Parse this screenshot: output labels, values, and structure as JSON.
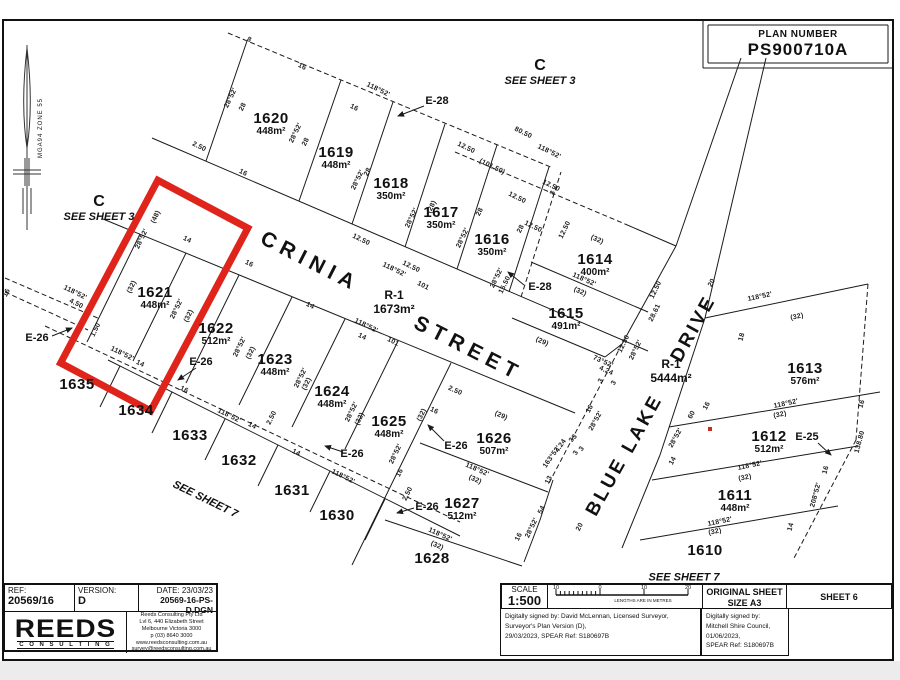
{
  "page": {
    "red": "#df241b",
    "line": "#1a1a1a"
  },
  "plan_number": {
    "label": "PLAN NUMBER",
    "value": "PS900710A"
  },
  "north": {
    "label": "MGA94  ZONE 55"
  },
  "sheet_refs": [
    {
      "big": "C",
      "sub": "SEE SHEET 3",
      "x": 540,
      "y": 72,
      "rot": 0
    },
    {
      "big": "C",
      "sub": "SEE SHEET 3",
      "x": 99,
      "y": 208,
      "rot": 0
    },
    {
      "big": "",
      "sub": "SEE SHEET 7",
      "x": 205,
      "y": 500,
      "rot": 26
    },
    {
      "big": "",
      "sub": "SEE SHEET 7",
      "x": 684,
      "y": 578,
      "rot": 0
    }
  ],
  "streets": {
    "names": [
      "CRINIA STREET",
      "BLUE LAKE DRIVE"
    ],
    "words": [
      {
        "text": "CRINIA",
        "x": 310,
        "y": 262,
        "rot": 27,
        "fs": 21,
        "ls": 6
      },
      {
        "text": "STREET",
        "x": 468,
        "y": 349,
        "rot": 27,
        "fs": 21,
        "ls": 6
      },
      {
        "text": "BLUE",
        "x": 607,
        "y": 487,
        "rot": -61,
        "fs": 19,
        "ls": 3
      },
      {
        "text": "LAKE",
        "x": 643,
        "y": 424,
        "rot": -61,
        "fs": 19,
        "ls": 3
      },
      {
        "text": "DRIVE",
        "x": 694,
        "y": 329,
        "rot": -61,
        "fs": 19,
        "ls": 3
      }
    ]
  },
  "reserves": [
    {
      "id": "R-1",
      "area": "1673m²",
      "x": 394,
      "y": 303
    },
    {
      "id": "R-1",
      "area": "5444m²",
      "x": 671,
      "y": 372
    }
  ],
  "lots": [
    {
      "num": "1620",
      "area": "448m²",
      "x": 271,
      "y": 124
    },
    {
      "num": "1619",
      "area": "448m²",
      "x": 336,
      "y": 158
    },
    {
      "num": "1618",
      "area": "350m²",
      "x": 391,
      "y": 189
    },
    {
      "num": "1617",
      "area": "350m²",
      "x": 441,
      "y": 218
    },
    {
      "num": "1616",
      "area": "350m²",
      "x": 492,
      "y": 245
    },
    {
      "num": "1614",
      "area": "400m²",
      "x": 595,
      "y": 265
    },
    {
      "num": "1615",
      "area": "491m²",
      "x": 566,
      "y": 319
    },
    {
      "num": "1613",
      "area": "576m²",
      "x": 805,
      "y": 374
    },
    {
      "num": "1612",
      "area": "512m²",
      "x": 769,
      "y": 442
    },
    {
      "num": "1611",
      "area": "448m²",
      "x": 735,
      "y": 501
    },
    {
      "num": "1610",
      "area": "",
      "x": 705,
      "y": 551
    },
    {
      "num": "1621",
      "area": "448m²",
      "x": 155,
      "y": 298,
      "highlight": true
    },
    {
      "num": "1622",
      "area": "512m²",
      "x": 216,
      "y": 334
    },
    {
      "num": "1623",
      "area": "448m²",
      "x": 275,
      "y": 365
    },
    {
      "num": "1624",
      "area": "448m²",
      "x": 332,
      "y": 397
    },
    {
      "num": "1625",
      "area": "448m²",
      "x": 389,
      "y": 427
    },
    {
      "num": "1626",
      "area": "507m²",
      "x": 494,
      "y": 444
    },
    {
      "num": "1627",
      "area": "512m²",
      "x": 462,
      "y": 509
    },
    {
      "num": "1628",
      "area": "",
      "x": 432,
      "y": 559
    },
    {
      "num": "1630",
      "area": "",
      "x": 337,
      "y": 516
    },
    {
      "num": "1631",
      "area": "",
      "x": 292,
      "y": 491
    },
    {
      "num": "1632",
      "area": "",
      "x": 239,
      "y": 461
    },
    {
      "num": "1633",
      "area": "",
      "x": 190,
      "y": 436
    },
    {
      "num": "1634",
      "area": "",
      "x": 136,
      "y": 411
    },
    {
      "num": "1635",
      "area": "",
      "x": 77,
      "y": 385
    }
  ],
  "easements": [
    {
      "id": "E-28",
      "x": 437,
      "y": 101,
      "arrow": [
        424,
        106,
        398,
        116
      ]
    },
    {
      "id": "E-28",
      "x": 540,
      "y": 287,
      "arrow": [
        524,
        285,
        508,
        272
      ]
    },
    {
      "id": "E-26",
      "x": 37,
      "y": 338,
      "arrow": [
        52,
        336,
        72,
        328
      ]
    },
    {
      "id": "E-26",
      "x": 201,
      "y": 362,
      "arrow": [
        196,
        368,
        178,
        380
      ]
    },
    {
      "id": "E-26",
      "x": 352,
      "y": 454,
      "arrow": [
        343,
        452,
        325,
        446
      ]
    },
    {
      "id": "E-26",
      "x": 456,
      "y": 446,
      "arrow": [
        444,
        441,
        428,
        425
      ]
    },
    {
      "id": "E-26",
      "x": 427,
      "y": 507,
      "arrow": [
        414,
        508,
        397,
        513
      ]
    },
    {
      "id": "E-25",
      "x": 807,
      "y": 437,
      "arrow": [
        818,
        443,
        831,
        455
      ]
    }
  ],
  "annotations": [
    [
      "8",
      249,
      40,
      26
    ],
    [
      "16",
      302,
      67,
      26
    ],
    [
      "118°52'",
      378,
      90,
      26
    ],
    [
      "16",
      354,
      108,
      26
    ],
    [
      "12.50",
      466,
      148,
      26
    ],
    [
      "80.50",
      523,
      133,
      26
    ],
    [
      "118°52'",
      549,
      152,
      26
    ],
    [
      "(101.50)",
      492,
      167,
      26
    ],
    [
      "12.50",
      551,
      186,
      26
    ],
    [
      "12.50",
      517,
      198,
      26
    ],
    [
      "12.50",
      533,
      227,
      26
    ],
    [
      "28°52'",
      231,
      98,
      -64
    ],
    [
      "28",
      243,
      107,
      -64
    ],
    [
      "2.50",
      199,
      147,
      26
    ],
    [
      "16",
      243,
      173,
      26
    ],
    [
      "28°52'",
      296,
      133,
      -64
    ],
    [
      "28",
      306,
      142,
      -64
    ],
    [
      "28°52'",
      358,
      180,
      -64
    ],
    [
      "28",
      368,
      172,
      -64
    ],
    [
      "28°52'",
      412,
      218,
      -64
    ],
    [
      "(28)",
      432,
      207,
      -64
    ],
    [
      "28°52'",
      463,
      238,
      -64
    ],
    [
      "28",
      480,
      212,
      -64
    ],
    [
      "28°52'",
      497,
      278,
      -64
    ],
    [
      "15.50",
      505,
      285,
      -64
    ],
    [
      "28",
      521,
      229,
      -64
    ],
    [
      "3",
      553,
      193,
      -64
    ],
    [
      "12.50",
      565,
      230,
      -64
    ],
    [
      "(32)",
      597,
      240,
      24
    ],
    [
      "118°52'",
      584,
      280,
      24
    ],
    [
      "(32)",
      580,
      292,
      24
    ],
    [
      "12.50",
      656,
      290,
      -64
    ],
    [
      "28.61",
      655,
      313,
      -64
    ],
    [
      "12.50",
      624,
      344,
      -64
    ],
    [
      "28°52'",
      636,
      350,
      -64
    ],
    [
      "73°52'",
      603,
      362,
      24
    ],
    [
      "4.24",
      606,
      371,
      24
    ],
    [
      "(29)",
      542,
      342,
      24
    ],
    [
      "12.50",
      361,
      240,
      26
    ],
    [
      "118°52'",
      394,
      270,
      26
    ],
    [
      "101",
      423,
      286,
      26
    ],
    [
      "12.50",
      411,
      267,
      26
    ],
    [
      "118°52'",
      366,
      326,
      26
    ],
    [
      "14",
      362,
      337,
      26
    ],
    [
      "101",
      393,
      342,
      26
    ],
    [
      "16",
      249,
      264,
      26
    ],
    [
      "14",
      310,
      306,
      26
    ],
    [
      "(48)",
      156,
      217,
      -64
    ],
    [
      "28°52'",
      142,
      239,
      -64
    ],
    [
      "14",
      187,
      240,
      26
    ],
    [
      "(32)",
      132,
      287,
      -64
    ],
    [
      "28°52'",
      177,
      309,
      -64
    ],
    [
      "(32)",
      189,
      316,
      -64
    ],
    [
      "118°52'",
      75,
      293,
      26
    ],
    [
      "4.50",
      76,
      304,
      26
    ],
    [
      "16",
      7,
      293,
      -64
    ],
    [
      "1.50",
      96,
      330,
      -64
    ],
    [
      "118°52'",
      122,
      354,
      26
    ],
    [
      "14",
      140,
      364,
      26
    ],
    [
      "16",
      184,
      390,
      26
    ],
    [
      "28°52'",
      240,
      347,
      -64
    ],
    [
      "(32)",
      251,
      353,
      -64
    ],
    [
      "28°52'",
      301,
      378,
      -64
    ],
    [
      "(32)",
      307,
      384,
      -64
    ],
    [
      "28°52'",
      352,
      412,
      -64
    ],
    [
      "(32)",
      360,
      419,
      -64
    ],
    [
      "28°52'",
      396,
      454,
      -64
    ],
    [
      "16",
      400,
      473,
      -64
    ],
    [
      "(32)",
      422,
      415,
      -64
    ],
    [
      "2.50",
      408,
      494,
      -64
    ],
    [
      "16",
      434,
      411,
      26
    ],
    [
      "2.50",
      455,
      391,
      24
    ],
    [
      "(29)",
      501,
      416,
      24
    ],
    [
      "4.24",
      561,
      446,
      -55
    ],
    [
      "163°52'",
      552,
      457,
      -55
    ],
    [
      "3",
      575,
      437,
      -55
    ],
    [
      "3",
      582,
      449,
      -55
    ],
    [
      "13",
      549,
      480,
      -64
    ],
    [
      "118°52'",
      477,
      470,
      24
    ],
    [
      "(32)",
      475,
      480,
      24
    ],
    [
      "118°52'",
      440,
      535,
      24
    ],
    [
      "(32)",
      437,
      546,
      24
    ],
    [
      "16",
      519,
      537,
      -64
    ],
    [
      "28°52'",
      532,
      528,
      -64
    ],
    [
      "54",
      542,
      510,
      -64
    ],
    [
      "20",
      580,
      527,
      -64
    ],
    [
      "118°52'",
      229,
      416,
      26
    ],
    [
      "14",
      252,
      426,
      26
    ],
    [
      "2.50",
      272,
      418,
      -64
    ],
    [
      "14",
      296,
      453,
      26
    ],
    [
      "118°52'",
      343,
      477,
      26
    ],
    [
      "20",
      712,
      283,
      -61
    ],
    [
      "16",
      707,
      406,
      -61
    ],
    [
      "60",
      692,
      415,
      -61
    ],
    [
      "28°52'",
      676,
      438,
      -61
    ],
    [
      "14",
      673,
      461,
      -61
    ],
    [
      "16",
      590,
      409,
      -61
    ],
    [
      "28°52'",
      596,
      421,
      -61
    ],
    [
      "3",
      601,
      381,
      -61
    ],
    [
      "3",
      614,
      383,
      -61
    ],
    [
      "3",
      572,
      440,
      -61
    ],
    [
      "3",
      576,
      453,
      -61
    ],
    [
      "118°52'",
      760,
      297,
      -12
    ],
    [
      "(32)",
      797,
      317,
      -12
    ],
    [
      "18",
      742,
      337,
      -75
    ],
    [
      "118°52'",
      786,
      404,
      -12
    ],
    [
      "(32)",
      780,
      415,
      -12
    ],
    [
      "118°52'",
      750,
      466,
      -12
    ],
    [
      "(32)",
      745,
      478,
      -12
    ],
    [
      "118°52'",
      720,
      522,
      -12
    ],
    [
      "(32)",
      715,
      532,
      -12
    ],
    [
      "16",
      862,
      404,
      -75
    ],
    [
      "16",
      826,
      470,
      -75
    ],
    [
      "138.80",
      860,
      442,
      -75
    ],
    [
      "208°52'",
      816,
      495,
      -75
    ],
    [
      "14",
      791,
      527,
      -75
    ]
  ],
  "highlight": {
    "x": 103,
    "y": 192,
    "w": 102,
    "h": 207,
    "cx": 154,
    "cy": 296,
    "rot": 28
  },
  "red_dot": {
    "x": 710,
    "y": 429
  },
  "geometry": {
    "solid": [
      [
        152,
        138,
        648,
        351
      ],
      [
        103,
        219,
        575,
        413
      ],
      [
        206,
        161,
        247,
        41
      ],
      [
        299,
        201,
        341,
        80
      ],
      [
        352,
        224,
        393,
        102
      ],
      [
        405,
        247,
        445,
        124
      ],
      [
        457,
        269,
        497,
        145
      ],
      [
        509,
        292,
        549,
        167
      ],
      [
        625,
        224,
        676,
        246
      ],
      [
        531,
        262,
        648,
        312
      ],
      [
        512,
        318,
        605,
        357
      ],
      [
        605,
        357,
        622,
        344
      ],
      [
        676,
        246,
        622,
        344
      ],
      [
        676,
        246,
        741,
        58
      ],
      [
        705,
        318,
        766,
        58
      ],
      [
        705,
        318,
        868,
        284
      ],
      [
        705,
        318,
        660,
        455
      ],
      [
        660,
        455,
        622,
        548
      ],
      [
        669,
        427,
        880,
        392
      ],
      [
        652,
        480,
        858,
        446
      ],
      [
        640,
        540,
        838,
        506
      ],
      [
        140,
        234,
        87,
        342
      ],
      [
        186,
        253,
        133,
        361
      ],
      [
        239,
        275,
        186,
        383
      ],
      [
        292,
        297,
        239,
        405
      ],
      [
        345,
        319,
        292,
        427
      ],
      [
        398,
        341,
        345,
        449
      ],
      [
        451,
        363,
        398,
        471
      ],
      [
        420,
        443,
        548,
        492
      ],
      [
        385,
        520,
        522,
        566
      ],
      [
        398,
        471,
        375,
        518
      ],
      [
        375,
        518,
        352,
        565
      ],
      [
        553,
        480,
        540,
        520
      ],
      [
        540,
        520,
        524,
        562
      ],
      [
        108,
        360,
        460,
        536
      ],
      [
        120,
        366,
        100,
        407
      ],
      [
        172,
        392,
        152,
        433
      ],
      [
        225,
        419,
        205,
        460
      ],
      [
        278,
        445,
        258,
        486
      ],
      [
        330,
        471,
        310,
        512
      ],
      [
        385,
        499,
        365,
        540
      ],
      [
        703,
        20,
        703,
        68
      ],
      [
        703,
        68,
        893,
        68
      ],
      [
        708,
        25,
        888,
        25
      ],
      [
        888,
        25,
        888,
        63
      ],
      [
        708,
        63,
        888,
        63
      ],
      [
        708,
        25,
        708,
        63
      ]
    ],
    "dashed": [
      [
        228,
        33,
        553,
        168
      ],
      [
        455,
        152,
        625,
        224
      ],
      [
        521,
        297,
        561,
        172
      ],
      [
        45,
        326,
        460,
        522
      ],
      [
        622,
        344,
        548,
        485
      ],
      [
        5,
        278,
        100,
        319
      ],
      [
        5,
        292,
        88,
        330
      ],
      [
        868,
        284,
        856,
        440
      ],
      [
        856,
        440,
        793,
        560
      ]
    ]
  },
  "titleblock_left": {
    "ref_label": "REF:",
    "ref": "20569/16",
    "version_label": "VERSION:",
    "version": "D",
    "date": "DATE:  23/03/23",
    "file": "20569-16-PS-D.DGN",
    "logo": "REEDS",
    "logo_sub": "C O N S U L T I N G",
    "address": [
      "Reeds Consulting Pty Ltd",
      "Lvl 6, 440 Elizabeth Street",
      "Melbourne Victoria 3000",
      "p (03) 8640 3000",
      "www.reedsconsulting.com.au",
      "survey@reedsconsulting.com.au"
    ]
  },
  "titleblock_right": {
    "scale_label": "SCALE",
    "scale": "1:500",
    "bar_labels": [
      "10",
      "0",
      "10",
      "20"
    ],
    "bar_caption": "LENGTHS ARE IN METRES",
    "sheet_size_label": "ORIGINAL SHEET",
    "sheet_size": "SIZE   A3",
    "sheet": "SHEET 6",
    "sig_left": [
      "Digitally signed by: David McLennan, Licensed Surveyor,",
      "Surveyor's Plan Version (D),",
      "29/03/2023, SPEAR Ref: S180697B"
    ],
    "sig_right": [
      "Digitally signed by:",
      "Mitchell Shire Council,",
      "01/06/2023,",
      "SPEAR Ref: S180697B"
    ]
  }
}
